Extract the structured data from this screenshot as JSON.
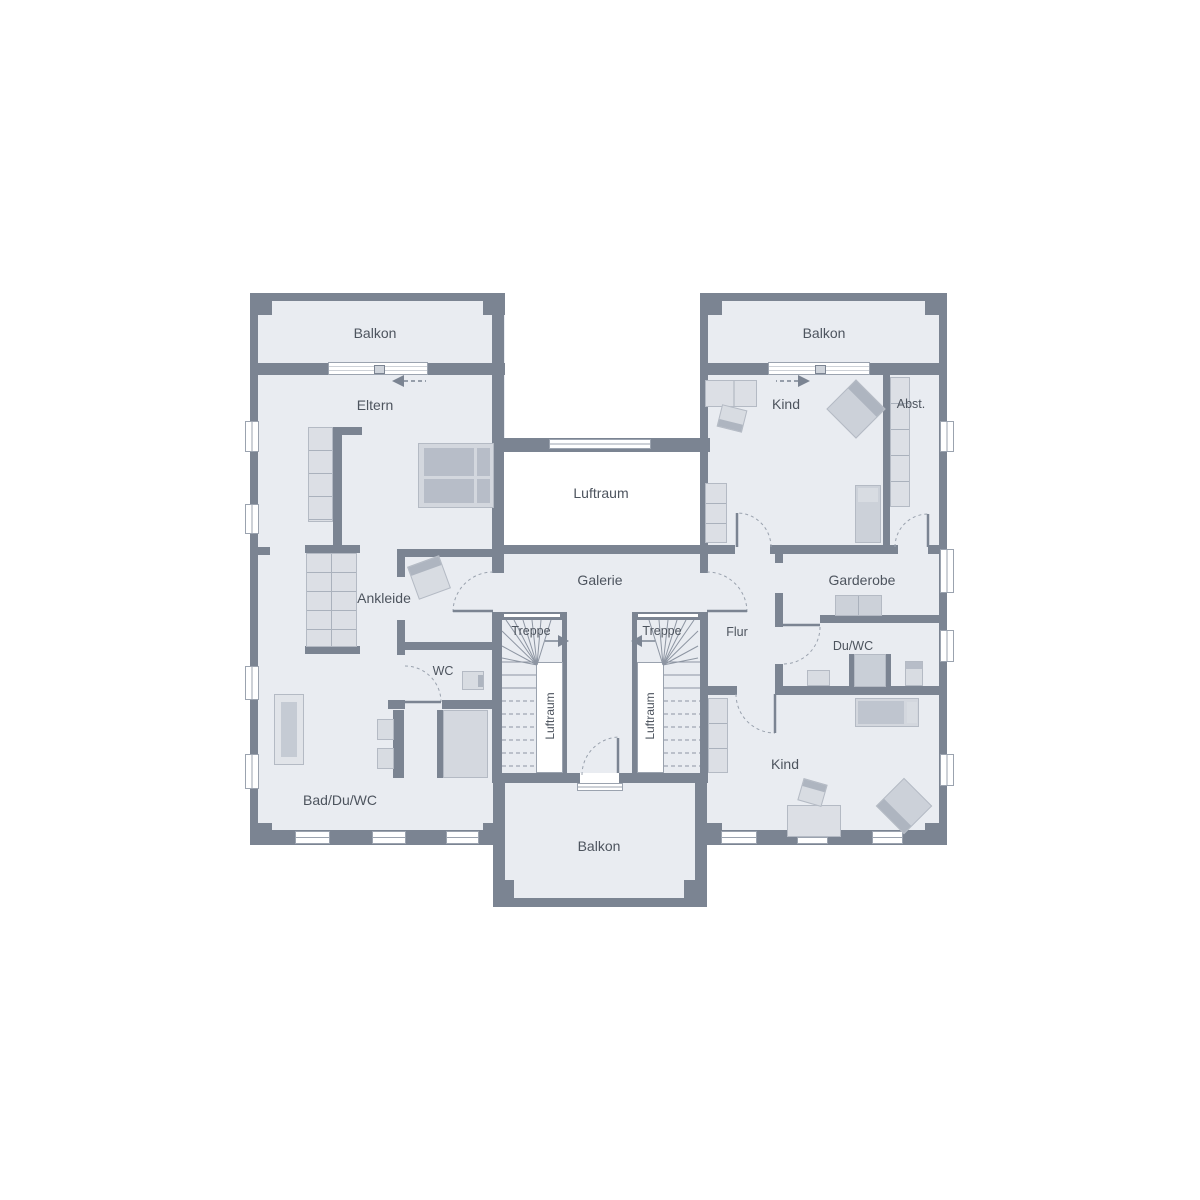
{
  "plan": {
    "type": "floor-plan",
    "colors": {
      "background": "#ffffff",
      "wall": "#7b8492",
      "floor": "#e9ecf1",
      "furniture": "#d9dde3",
      "furniture_dark": "#b7bdc8",
      "accent_band": "#aeb5c0",
      "line": "#9aa2ae",
      "text": "#4d545e"
    },
    "rooms": {
      "balkon_top_left": "Balkon",
      "balkon_top_right": "Balkon",
      "balkon_bottom": "Balkon",
      "eltern": "Eltern",
      "ankleide": "Ankleide",
      "wc": "WC",
      "bad_du_wc": "Bad/Du/WC",
      "luftraum_center": "Luftraum",
      "galerie": "Galerie",
      "treppe_left": "Treppe",
      "treppe_right": "Treppe",
      "luftraum_stair_left": "Luftraum",
      "luftraum_stair_right": "Luftraum",
      "flur": "Flur",
      "garderobe": "Garderobe",
      "du_wc": "Du/WC",
      "kind_top": "Kind",
      "kind_bottom": "Kind",
      "abstellraum": "Abst."
    }
  }
}
